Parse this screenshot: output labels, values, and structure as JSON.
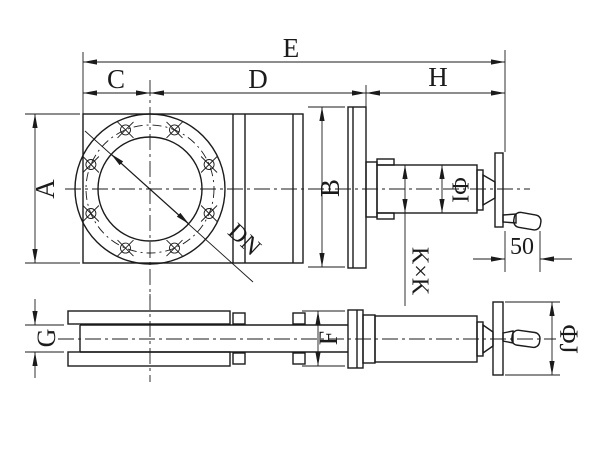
{
  "colors": {
    "ink": "#1b1b1b",
    "paper": "#ffffff"
  },
  "dims": {
    "e": "E",
    "c": "C",
    "d": "D",
    "h": "H",
    "a": "A",
    "b": "B",
    "dn": "DN",
    "kxk": "K×K",
    "phi_i": "ΦI",
    "handle_len": "50",
    "g": "G",
    "f": "F",
    "phi_j": "ΦJ"
  }
}
